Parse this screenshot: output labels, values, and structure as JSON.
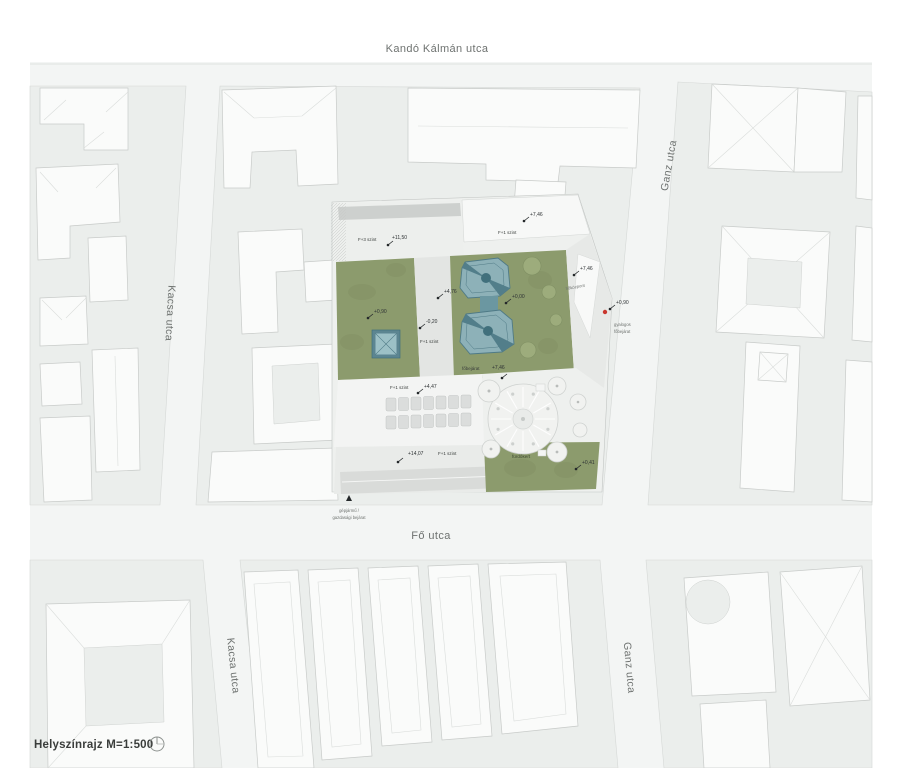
{
  "drawing": {
    "title": "Helyszínrajz M=1:500",
    "north_icon": "north-arrow"
  },
  "streets": {
    "kando": "Kandó Kálmán utca",
    "kacsa_top": "Kacsa utca",
    "ganz_top": "Ganz utca",
    "fo": "Fő utca",
    "kacsa_bottom": "Kacsa utca",
    "ganz_bottom": "Ganz utca"
  },
  "labels": {
    "f3": "F+3 szint",
    "e1150": "+11,50",
    "e746_top": "+7,46",
    "f1_top": "F+1 szint",
    "e090_court": "+0,90",
    "e476": "+4,76",
    "em020": "-0,20",
    "f1_path": "F+1 szint",
    "e000": "+0,00",
    "e746_right": "+7,46",
    "hokozpont": "hőközpont",
    "e090_street": "+0,90",
    "ped1": "gyalogos",
    "ped2": "főbejárat",
    "fobejarat": "főbejárat",
    "e746_mid": "+7,46",
    "f1_mid": "F+1 szint",
    "e447": "+4,47",
    "e1407": "+14,07",
    "f1_bottom": "F+1 szint",
    "furdokert": "fürdőkert",
    "e041": "+0,41",
    "veh1": "gépjármű /",
    "veh2": "gazdasági bejárat"
  },
  "colors": {
    "street": "#f3f5f4",
    "block": "#ebeeec",
    "building": "#fafbfa",
    "site_green": "#8c9b6d",
    "glass": "#8db1b8",
    "glass_dark": "#4e7a86",
    "dome": "#f1f2f0",
    "accent_red": "#c9372e",
    "text": "#2e3234"
  }
}
